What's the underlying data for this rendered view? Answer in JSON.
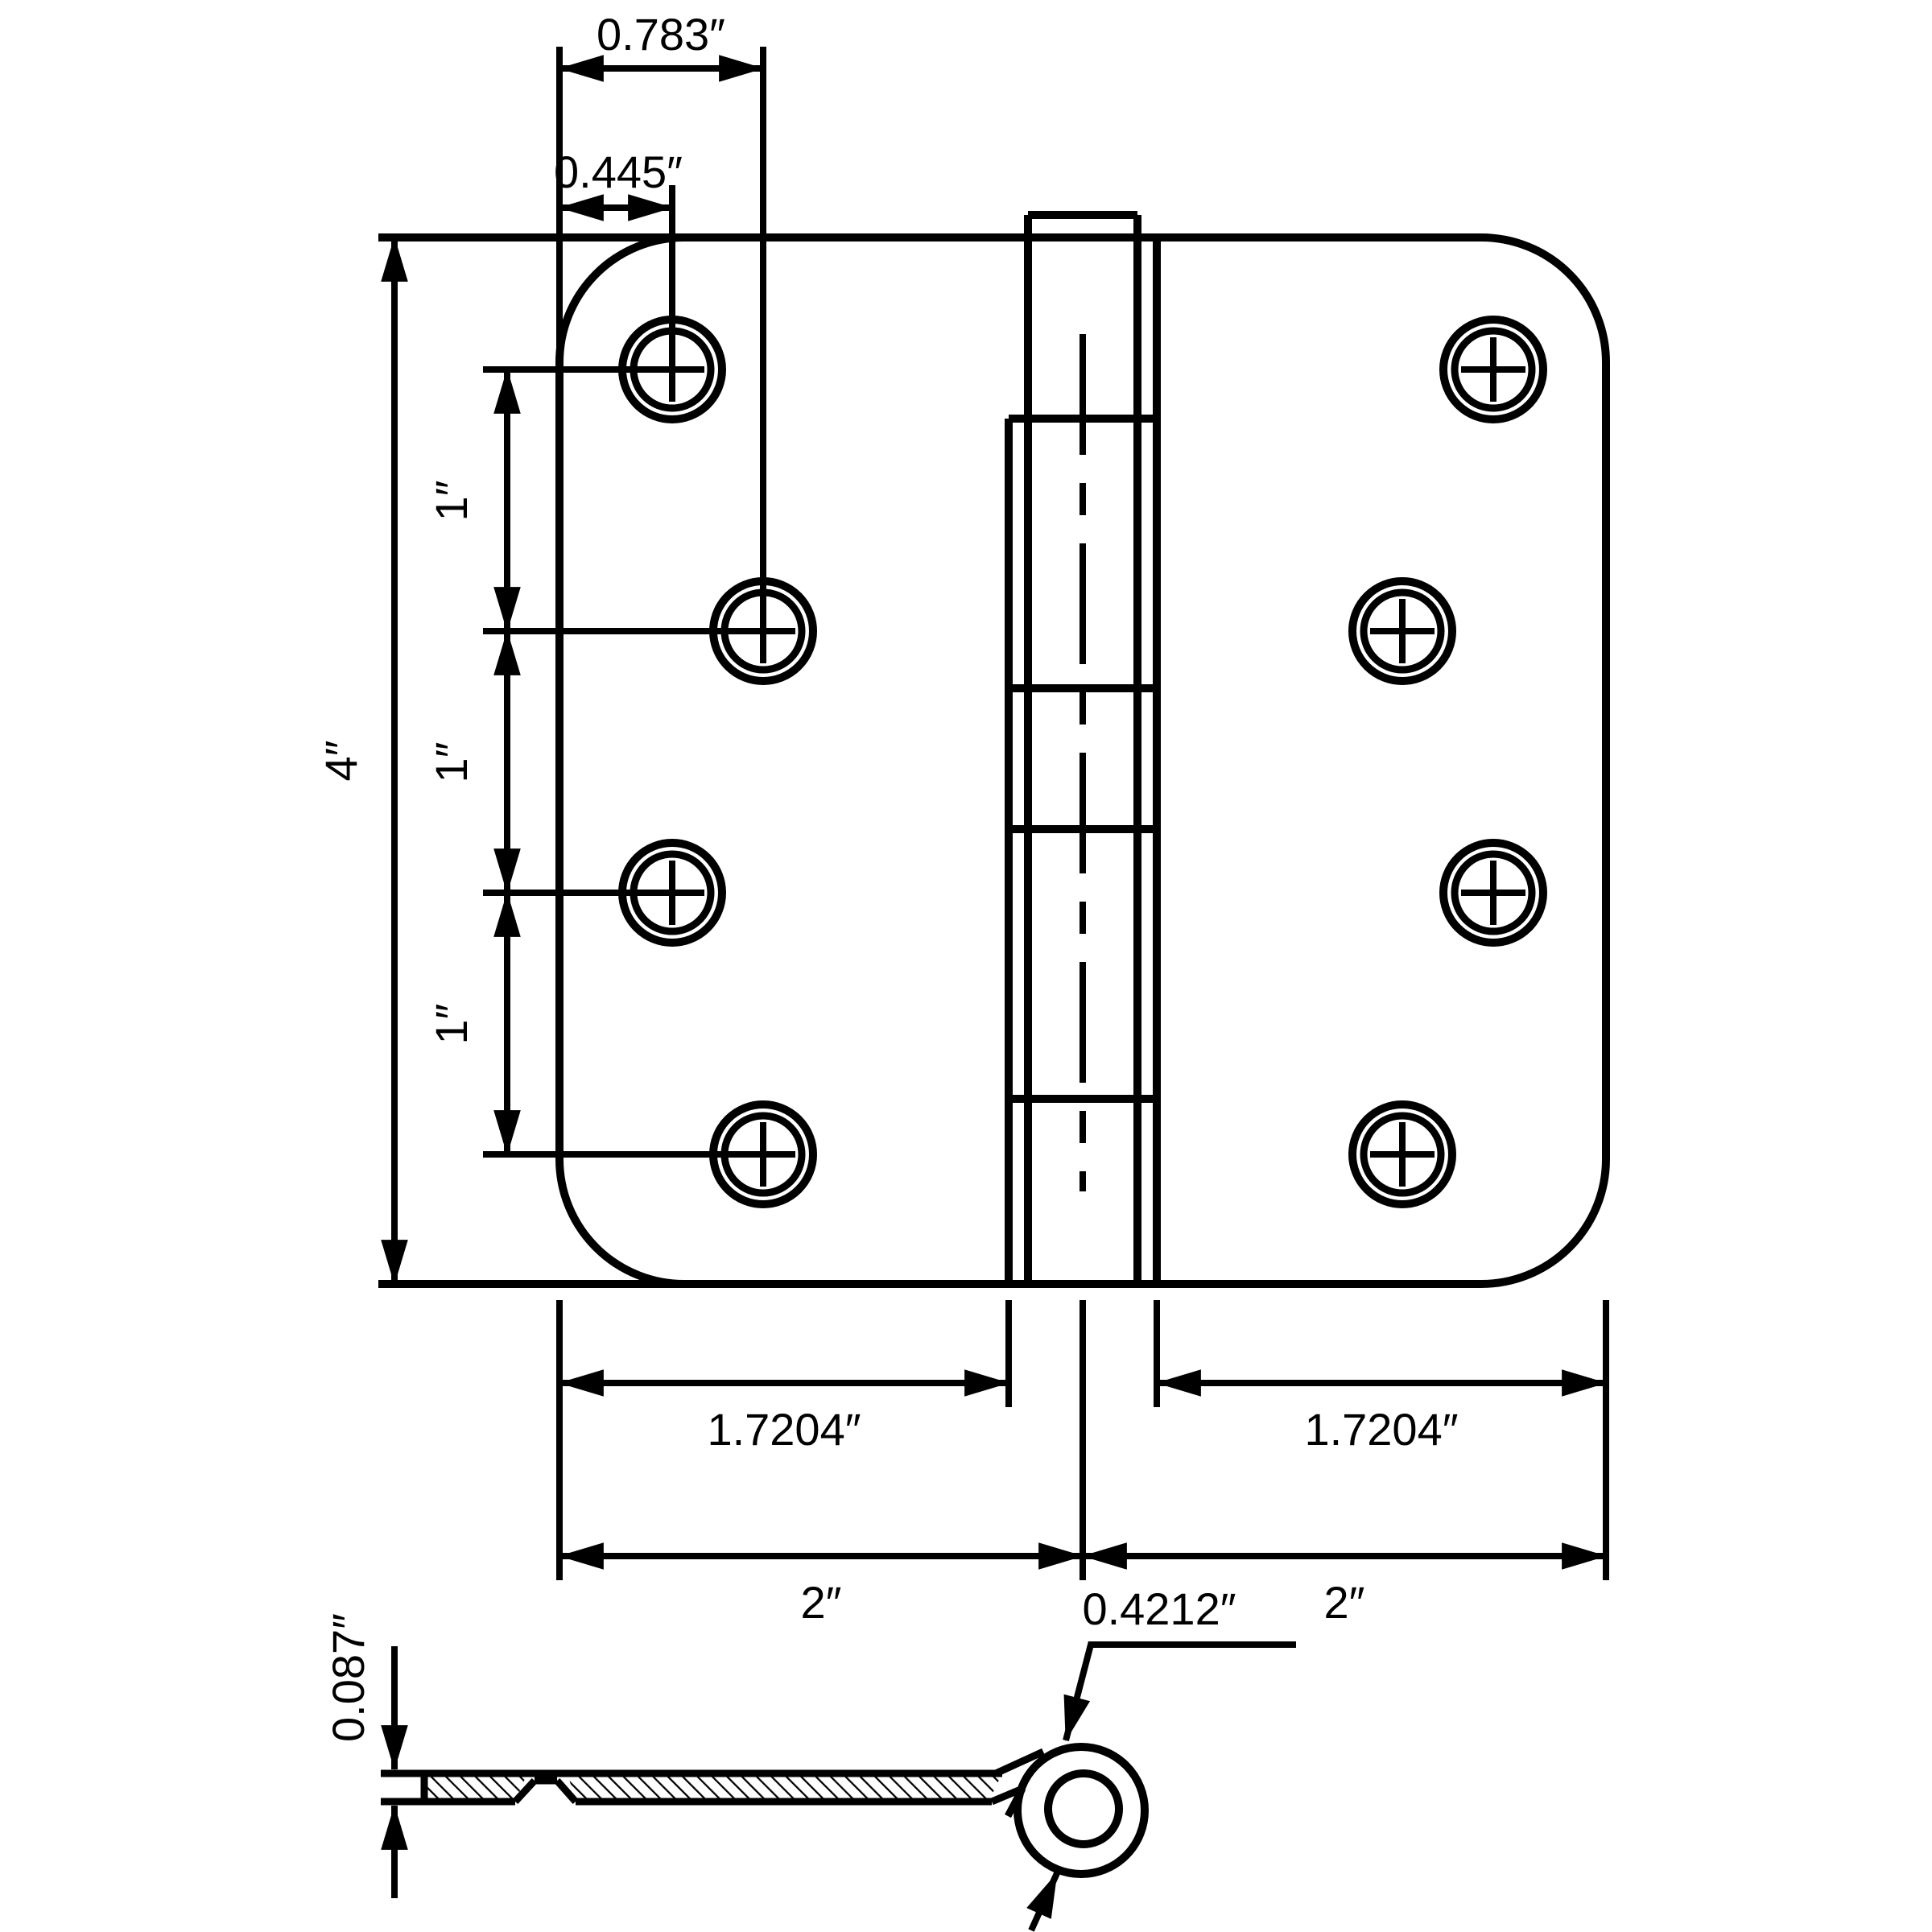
{
  "drawing": {
    "title": "door-hinge-dimensioned-drawing",
    "background": "#ffffff",
    "line_color": "#000000",
    "plan_view": {
      "dims": {
        "edge_to_hole_col2": "0.783″",
        "edge_to_hole_col1": "0.445″",
        "overall_height": "4″",
        "hole_spacing_1": "1″",
        "hole_spacing_2": "1″",
        "hole_spacing_3": "1″",
        "leaf_width_left": "1.7204″",
        "leaf_width_right": "1.7204″",
        "half_width_left": "2″",
        "half_width_right": "2″"
      }
    },
    "section_view": {
      "dims": {
        "leaf_thickness": "0.087″",
        "knuckle_diameter": "0.4212″"
      }
    }
  }
}
